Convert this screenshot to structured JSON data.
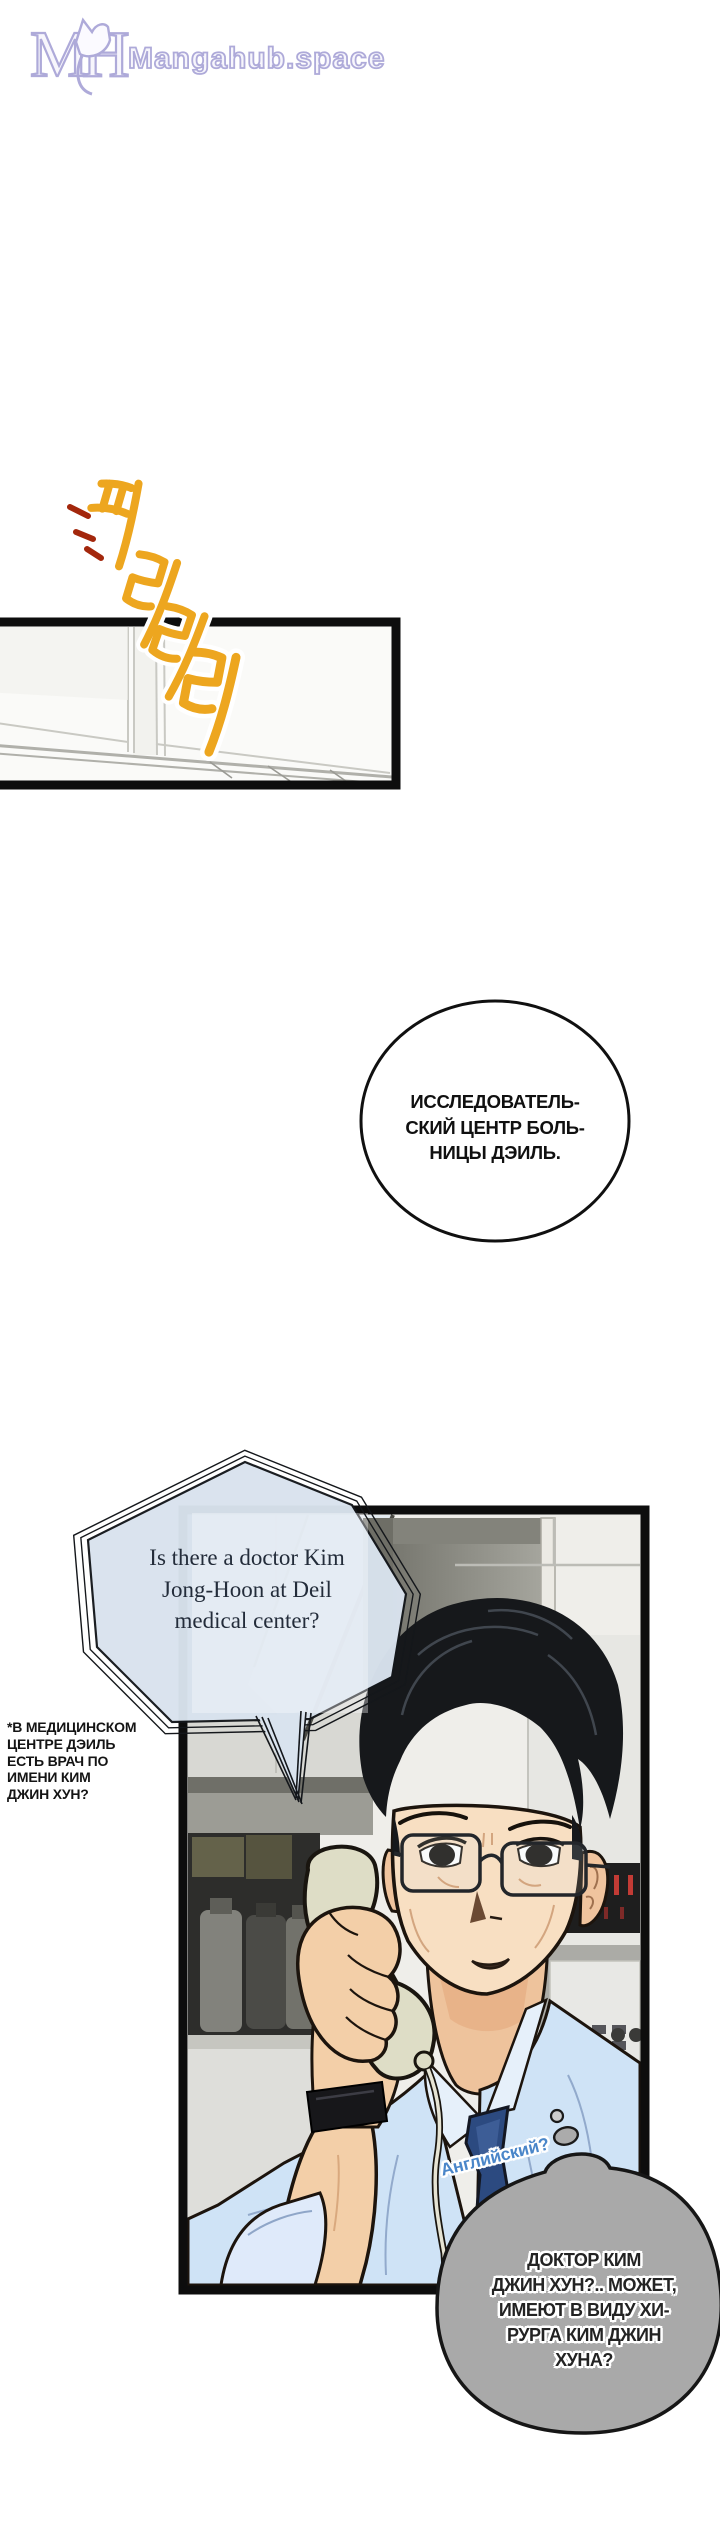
{
  "site": {
    "name": "Mangahub.space",
    "monogram": {
      "left": "M",
      "right": "H"
    },
    "brand_color": "#aeaad9"
  },
  "sfx_ring": {
    "text": "피리리리",
    "color_start": "#eda61f",
    "color_end": "#b84106"
  },
  "bubble_research_center": {
    "lines": [
      "ИССЛЕДОВАТЕЛЬ-",
      "СКИЙ ЦЕНТР БОЛЬ-",
      "НИЦЫ ДЭИЛЬ."
    ]
  },
  "bubble_phone_question": {
    "fill": "#d9e3ee",
    "lines": [
      "Is there a doctor Kim",
      "Jong-Hoon at Deil",
      "medical center?"
    ]
  },
  "translator_note": {
    "lines": [
      "*В МЕДИЦИНСКОМ",
      "ЦЕНТРЕ ДЭИЛЬ",
      "ЕСТЬ ВРАЧ ПО",
      "ИМЕНИ КИМ",
      "ДЖИН ХУН?"
    ]
  },
  "label_language": {
    "text": "Английский?",
    "color": "#4a86c9"
  },
  "bubble_thought": {
    "fill": "#a9a9a9",
    "lines": [
      "ДОКТОР КИМ",
      "ДЖИН ХУН?.. МОЖЕТ,",
      "ИМЕЮТ В ВИДУ ХИ-",
      "РУРГА КИМ ДЖИН",
      "ХУНА?"
    ]
  }
}
